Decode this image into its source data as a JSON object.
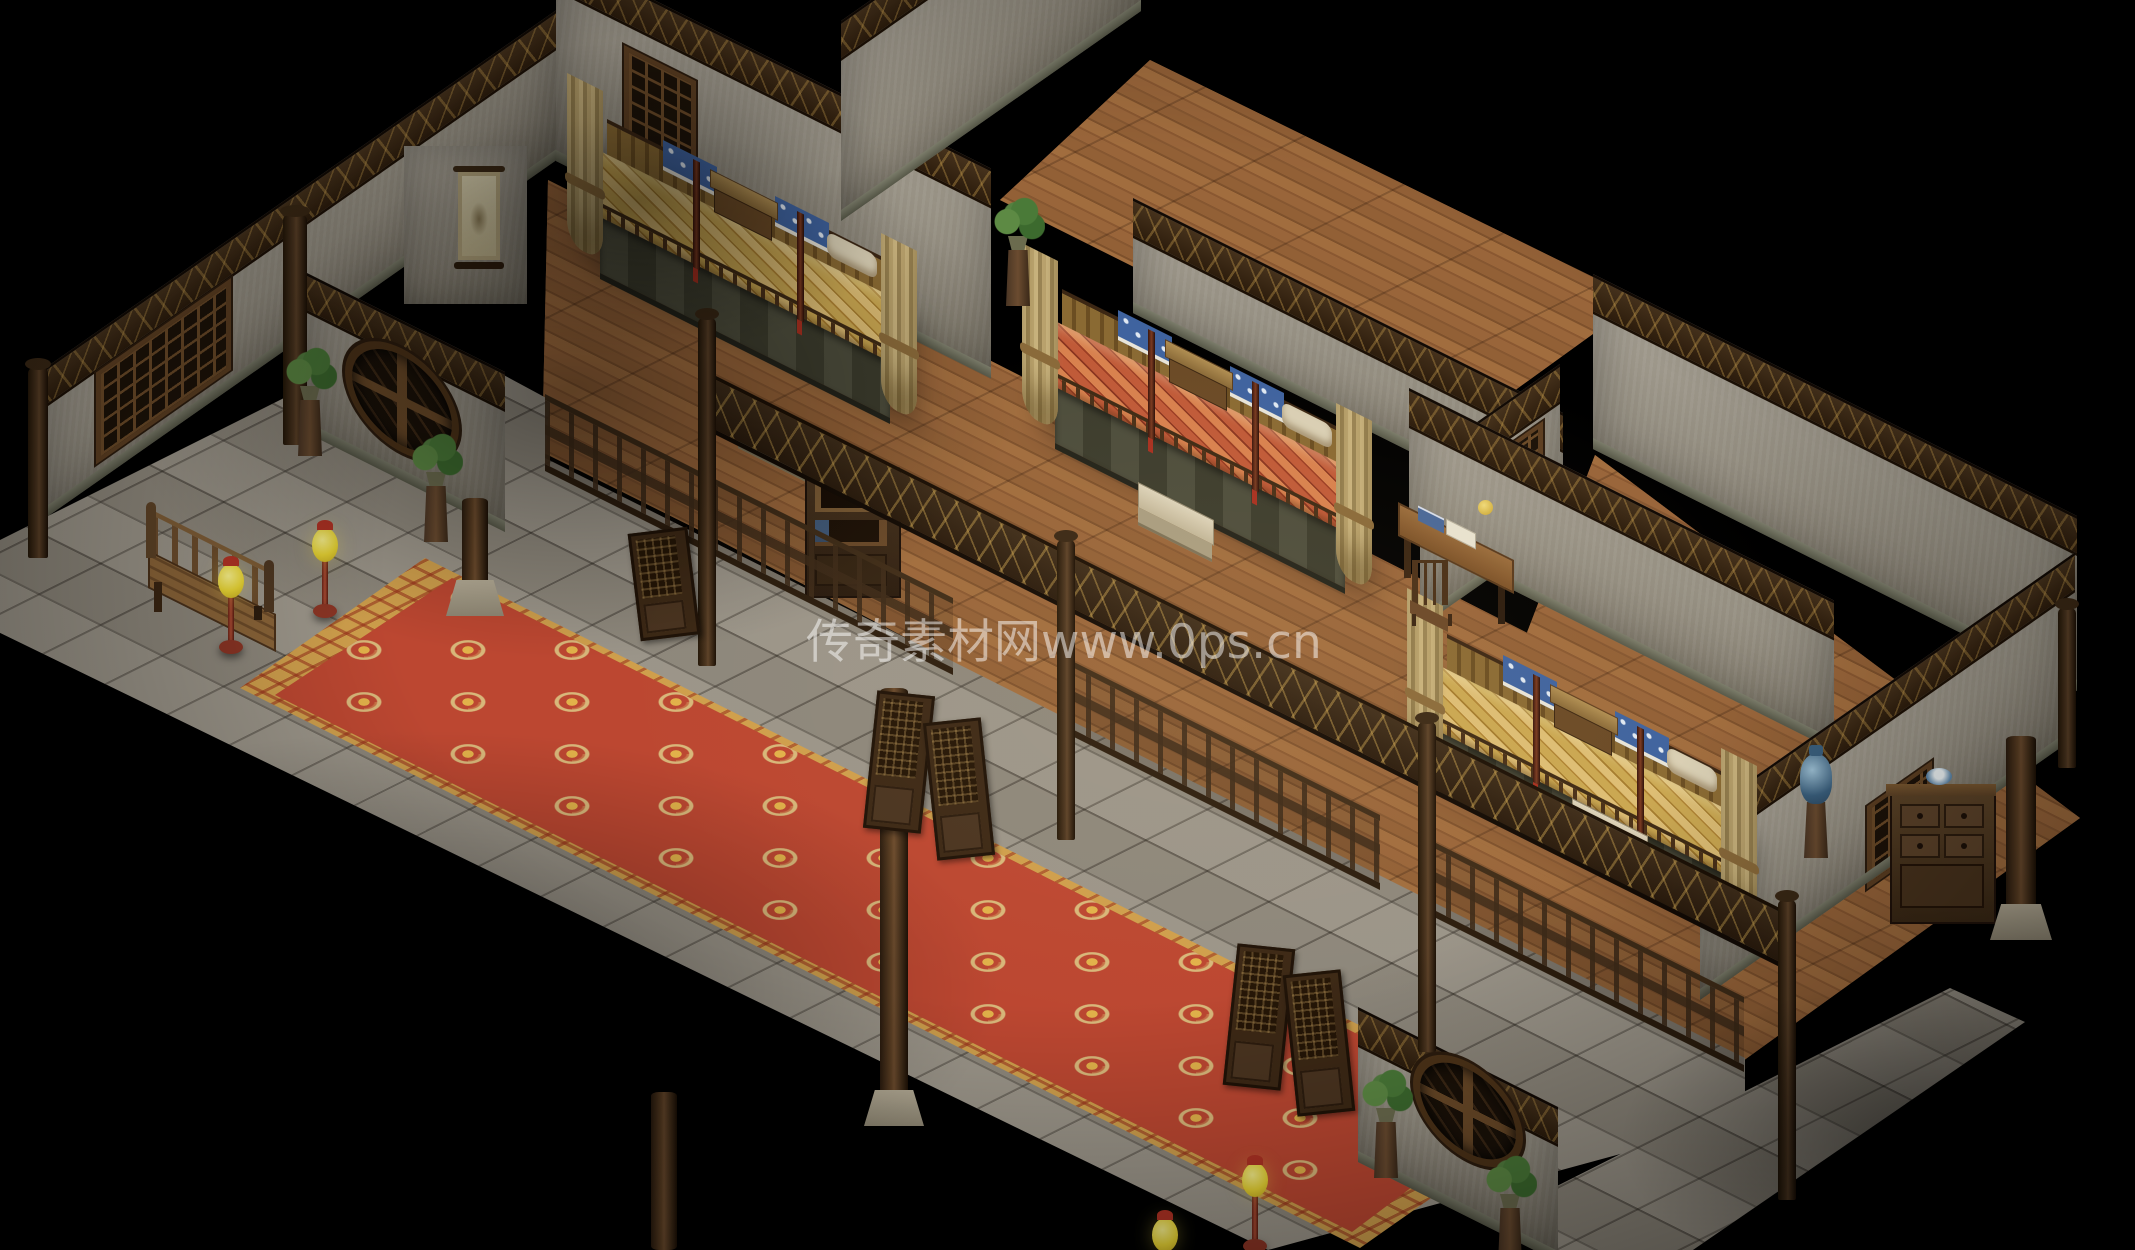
{
  "watermark": {
    "text": "传奇素材网www.0ps.cn"
  },
  "palette": {
    "void": "#000000",
    "plaster_wall": "#938d80",
    "dark_wood": "#3f2d1a",
    "wood_floor": "#94613a",
    "stone_floor": "#968f83",
    "carpet_red": "#bc4731",
    "carpet_gold": "#cf9f4c",
    "bedding_gold": "#caa751",
    "bedding_red": "#c05a38",
    "pillow_blue": "#3f639f",
    "lamp_yellow": "#e8d434",
    "lamp_red": "#b03224",
    "plant_green": "#4a7a38"
  },
  "scene": {
    "type": "isometric-game-interior",
    "description": "Isometric Chinese inn interior with three canopy-bed rooms, a stone corridor with long red patterned carpet, wooden railings, screen doors, lattice and moon windows, potted plants and yellow floor lamps.",
    "objects": [
      {
        "t": "floor",
        "n": "floor-wood-room1",
        "p": [
          [
            548,
            180
          ],
          [
            995,
            405
          ],
          [
            950,
            655
          ],
          [
            542,
            452
          ]
        ],
        "mat": "wood",
        "z": 2
      },
      {
        "t": "floor",
        "n": "floor-wood-room2",
        "p": [
          [
            930,
            330
          ],
          [
            1620,
            680
          ],
          [
            1390,
            890
          ],
          [
            680,
            520
          ]
        ],
        "mat": "wood",
        "z": 2
      },
      {
        "t": "floor",
        "n": "floor-wood-upper-corridor",
        "p": [
          [
            1150,
            60
          ],
          [
            1640,
            300
          ],
          [
            1460,
            430
          ],
          [
            1000,
            200
          ]
        ],
        "mat": "wood",
        "z": 2
      },
      {
        "t": "floor",
        "n": "floor-wood-room3",
        "p": [
          [
            1595,
            455
          ],
          [
            2080,
            818
          ],
          [
            1700,
            1092
          ],
          [
            1415,
            925
          ]
        ],
        "mat": "wood",
        "z": 2
      },
      {
        "t": "floor",
        "n": "floor-wood-room3-front",
        "p": [
          [
            1200,
            700
          ],
          [
            1750,
            980
          ],
          [
            1600,
            1090
          ],
          [
            1100,
            830
          ]
        ],
        "mat": "wood",
        "z": 2
      },
      {
        "t": "floor",
        "n": "floor-stone-corridor",
        "p": [
          [
            -10,
            545
          ],
          [
            420,
            330
          ],
          [
            550,
            400
          ],
          [
            545,
            458
          ],
          [
            950,
            660
          ],
          [
            1385,
            878
          ],
          [
            1745,
            1058
          ],
          [
            1745,
            1120
          ],
          [
            1268,
            1250
          ],
          [
            -10,
            628
          ]
        ],
        "mat": "stone",
        "z": 3
      },
      {
        "t": "floor",
        "n": "floor-stone-porch",
        "p": [
          [
            1545,
            1192
          ],
          [
            1950,
            988
          ],
          [
            2025,
            1022
          ],
          [
            1690,
            1252
          ],
          [
            1558,
            1252
          ]
        ],
        "mat": "stone",
        "z": 3
      },
      {
        "t": "floor",
        "n": "carpet-border",
        "p": [
          [
            425,
            558
          ],
          [
            1545,
            1118
          ],
          [
            1360,
            1248
          ],
          [
            240,
            688
          ]
        ],
        "mat": "carpetb",
        "z": 4
      },
      {
        "t": "floor",
        "n": "carpet-field",
        "p": [
          [
            452,
            578
          ],
          [
            1512,
            1112
          ],
          [
            1352,
            1232
          ],
          [
            275,
            695
          ]
        ],
        "mat": "carpet",
        "z": 5
      },
      {
        "t": "wall",
        "n": "wall-outer-northwest",
        "x": 41,
        "y": 521,
        "w": 515,
        "h": 150,
        "sk": -35,
        "z": 10,
        "win": {
          "l": 55,
          "t": 40,
          "w": 125,
          "h": 82
        }
      },
      {
        "t": "box",
        "n": "wall-pillar-northwest",
        "x": 404,
        "y": 146,
        "w": 123,
        "h": 158,
        "mat": "plaster",
        "z": 10
      },
      {
        "t": "wall",
        "n": "wall-room1-back",
        "x": 556,
        "y": 161,
        "w": 435,
        "h": 210,
        "sk": 26.57,
        "z": 10,
        "win": {
          "l": 68,
          "t": 60,
          "w": 62,
          "h": 82
        }
      },
      {
        "t": "wall",
        "n": "wall-room2-northwest",
        "x": 841,
        "y": 221,
        "w": 300,
        "h": 200,
        "sk": -35,
        "z": 10
      },
      {
        "t": "wall",
        "n": "wall-room2-back",
        "x": 1133,
        "y": 313,
        "w": 430,
        "h": 115,
        "sk": 26.57,
        "z": 10
      },
      {
        "t": "wall",
        "n": "wall-room2-room3-divider",
        "x": 1420,
        "y": 627,
        "w": 140,
        "h": 165,
        "sk": -35,
        "z": 11,
        "win": {
          "l": 55,
          "t": 45,
          "w": 58,
          "h": 70
        }
      },
      {
        "t": "wall",
        "n": "wall-room3-northwest",
        "x": 1409,
        "y": 538,
        "w": 425,
        "h": 150,
        "sk": 26.57,
        "z": 11
      },
      {
        "t": "wall",
        "n": "wall-room3-back",
        "x": 1593,
        "y": 449,
        "w": 484,
        "h": 175,
        "sk": 26.57,
        "z": 10
      },
      {
        "t": "wall",
        "n": "wall-room3-southeast",
        "x": 1700,
        "y": 1000,
        "w": 375,
        "h": 185,
        "sk": -35,
        "z": 11,
        "win": {
          "l": 167,
          "t": 108,
          "w": 55,
          "h": 73
        }
      },
      {
        "t": "wall",
        "n": "wall-moon-west",
        "x": 305,
        "y": 432,
        "w": 200,
        "h": 160,
        "sk": 26.57,
        "z": 12,
        "moon": {
          "l": 40,
          "t": 28,
          "rx": 50,
          "ry": 45
        }
      },
      {
        "t": "wall",
        "n": "wall-moon-south",
        "x": 1358,
        "y": 1162,
        "w": 200,
        "h": 155,
        "sk": 26.57,
        "z": 12,
        "moon": {
          "l": 55,
          "t": 0,
          "rx": 48,
          "ry": 42
        }
      },
      {
        "t": "bed",
        "n": "canopy-bed-room1",
        "x": 545,
        "y": 85,
        "w": 400,
        "h": 340,
        "c": "gold",
        "z": 11
      },
      {
        "t": "bed",
        "n": "canopy-bed-room2",
        "x": 1000,
        "y": 255,
        "w": 400,
        "h": 340,
        "c": "red",
        "z": 12
      },
      {
        "t": "bed",
        "n": "canopy-bed-room3",
        "x": 1385,
        "y": 600,
        "w": 400,
        "h": 340,
        "c": "gold",
        "z": 13
      },
      {
        "t": "railing",
        "n": "railing-room1-front",
        "x": 545,
        "y": 458,
        "w": 408,
        "h": 64,
        "sk": 26.57,
        "z": 14
      },
      {
        "t": "railing",
        "n": "railing-room2-front",
        "x": 1062,
        "y": 718,
        "w": 318,
        "h": 62,
        "sk": 26.57,
        "z": 14
      },
      {
        "t": "railing",
        "n": "railing-room3-front",
        "x": 1422,
        "y": 898,
        "w": 322,
        "h": 62,
        "sk": 26.57,
        "z": 14
      },
      {
        "t": "fascia",
        "n": "carved-fascia-beam",
        "x": 700,
        "y": 418,
        "w": 1090,
        "h": 50,
        "sk": 26.57,
        "z": 15
      },
      {
        "t": "post",
        "n": "post-corridor-1",
        "x": 698,
        "y": 318,
        "w": 18,
        "h": 348,
        "z": 16
      },
      {
        "t": "post",
        "n": "post-corridor-2",
        "x": 1057,
        "y": 540,
        "w": 18,
        "h": 300,
        "z": 16
      },
      {
        "t": "post",
        "n": "post-corridor-3",
        "x": 1418,
        "y": 722,
        "w": 18,
        "h": 330,
        "z": 16
      },
      {
        "t": "post",
        "n": "post-corridor-4",
        "x": 1778,
        "y": 900,
        "w": 18,
        "h": 300,
        "z": 16
      },
      {
        "t": "post",
        "n": "post-wall-west-end",
        "x": 28,
        "y": 368,
        "w": 20,
        "h": 190,
        "z": 16
      },
      {
        "t": "post",
        "n": "post-vestibule-corner",
        "x": 283,
        "y": 215,
        "w": 24,
        "h": 230,
        "z": 13
      },
      {
        "t": "post",
        "n": "post-room3-corner",
        "x": 2058,
        "y": 608,
        "w": 18,
        "h": 160,
        "z": 16
      },
      {
        "t": "column",
        "n": "column-corridor-1",
        "x": 462,
        "y": 498,
        "w": 26,
        "h": 112,
        "base": true,
        "z": 16
      },
      {
        "t": "column",
        "n": "column-corridor-2",
        "x": 880,
        "y": 688,
        "w": 28,
        "h": 432,
        "base": true,
        "z": 16
      },
      {
        "t": "column",
        "n": "column-corridor-3",
        "x": 651,
        "y": 1092,
        "w": 26,
        "h": 158,
        "base": false,
        "z": 16
      },
      {
        "t": "column",
        "n": "column-room3-east",
        "x": 2006,
        "y": 736,
        "w": 30,
        "h": 198,
        "base": true,
        "z": 16
      },
      {
        "t": "stool",
        "n": "bed-step-room1",
        "x": 738,
        "y": 405,
        "w": 80,
        "h": 46,
        "z": 13
      },
      {
        "t": "stool",
        "n": "bed-step-room2",
        "x": 1138,
        "y": 482,
        "w": 80,
        "h": 46,
        "z": 13
      },
      {
        "t": "stool",
        "n": "bed-step-room3",
        "x": 1572,
        "y": 798,
        "w": 80,
        "h": 46,
        "z": 14
      },
      {
        "t": "desk",
        "n": "writing-desk",
        "x": 1398,
        "y": 496,
        "w": 130,
        "h": 84,
        "z": 14
      },
      {
        "t": "chair",
        "n": "desk-chair",
        "x": 1410,
        "y": 560,
        "w": 44,
        "h": 66,
        "z": 15
      },
      {
        "t": "cabinet",
        "n": "bookshelf-cabinet",
        "x": 805,
        "y": 470,
        "w": 92,
        "h": 124,
        "z": 13
      },
      {
        "t": "sideboard",
        "n": "sideboard-room3",
        "x": 1890,
        "y": 788,
        "w": 102,
        "h": 132,
        "z": 13
      },
      {
        "t": "vase",
        "n": "porcelain-vase-stand",
        "x": 1796,
        "y": 744,
        "w": 40,
        "h": 116,
        "z": 14
      },
      {
        "t": "bench",
        "n": "wooden-daybed-bench",
        "x": 146,
        "y": 502,
        "w": 135,
        "h": 118,
        "z": 14
      },
      {
        "t": "plant",
        "n": "potted-plant-1",
        "x": 290,
        "y": 350,
        "w": 40,
        "h": 110,
        "z": 16
      },
      {
        "t": "plant",
        "n": "potted-plant-2",
        "x": 416,
        "y": 436,
        "w": 40,
        "h": 110,
        "z": 16
      },
      {
        "t": "plant",
        "n": "potted-plant-3",
        "x": 998,
        "y": 200,
        "w": 40,
        "h": 110,
        "z": 16
      },
      {
        "t": "plant",
        "n": "potted-plant-4",
        "x": 1366,
        "y": 1072,
        "w": 40,
        "h": 110,
        "z": 16
      },
      {
        "t": "plant",
        "n": "potted-plant-5",
        "x": 1490,
        "y": 1158,
        "w": 40,
        "h": 95,
        "z": 16
      },
      {
        "t": "lamp",
        "n": "floor-lamp-1",
        "i": true,
        "x": 216,
        "y": 556,
        "w": 30,
        "h": 108,
        "z": 16
      },
      {
        "t": "lamp",
        "n": "floor-lamp-2",
        "i": true,
        "x": 310,
        "y": 520,
        "w": 30,
        "h": 100,
        "z": 16
      },
      {
        "t": "lamp",
        "n": "floor-lamp-3",
        "i": true,
        "x": 1240,
        "y": 1155,
        "w": 30,
        "h": 108,
        "z": 16
      },
      {
        "t": "lamp",
        "n": "floor-lamp-4",
        "i": true,
        "x": 1150,
        "y": 1210,
        "w": 30,
        "h": 70,
        "z": 16
      },
      {
        "t": "door",
        "n": "swing-door-room1",
        "i": true,
        "x": 634,
        "y": 530,
        "w": 54,
        "h": 102,
        "rot": -7,
        "z": 17
      },
      {
        "t": "door",
        "n": "swing-door-room2-left",
        "i": true,
        "x": 870,
        "y": 693,
        "w": 52,
        "h": 132,
        "rot": 6,
        "z": 17
      },
      {
        "t": "door",
        "n": "swing-door-room2-right",
        "i": true,
        "x": 930,
        "y": 720,
        "w": 52,
        "h": 132,
        "rot": -6,
        "z": 17
      },
      {
        "t": "door",
        "n": "swing-door-room3-left",
        "i": true,
        "x": 1230,
        "y": 946,
        "w": 52,
        "h": 136,
        "rot": 6,
        "z": 17
      },
      {
        "t": "door",
        "n": "swing-door-room3-right",
        "i": true,
        "x": 1290,
        "y": 972,
        "w": 52,
        "h": 136,
        "rot": -6,
        "z": 17
      },
      {
        "t": "painting",
        "n": "scroll-painting",
        "x": 456,
        "y": 166,
        "w": 46,
        "h": 106,
        "z": 12
      },
      {
        "t": "glow",
        "n": "light-glow-center",
        "x": 620,
        "y": 330,
        "w": 1200,
        "h": 700,
        "z": 27
      },
      {
        "t": "shade",
        "n": "shadow-overlay-1",
        "x": 120,
        "y": 120,
        "w": 900,
        "h": 540,
        "z": 28
      },
      {
        "t": "shade",
        "n": "shadow-overlay-2",
        "x": -150,
        "y": 730,
        "w": 1150,
        "h": 520,
        "z": 28
      },
      {
        "t": "shade",
        "n": "shadow-overlay-3",
        "x": 1620,
        "y": 980,
        "w": 620,
        "h": 320,
        "z": 28
      },
      {
        "t": "shade",
        "n": "shadow-overlay-4",
        "x": 380,
        "y": 40,
        "w": 520,
        "h": 320,
        "z": 28
      },
      {
        "t": "edge",
        "n": "edge-vignette",
        "x": 0,
        "y": 0,
        "w": 2135,
        "h": 1250,
        "z": 29
      }
    ]
  }
}
